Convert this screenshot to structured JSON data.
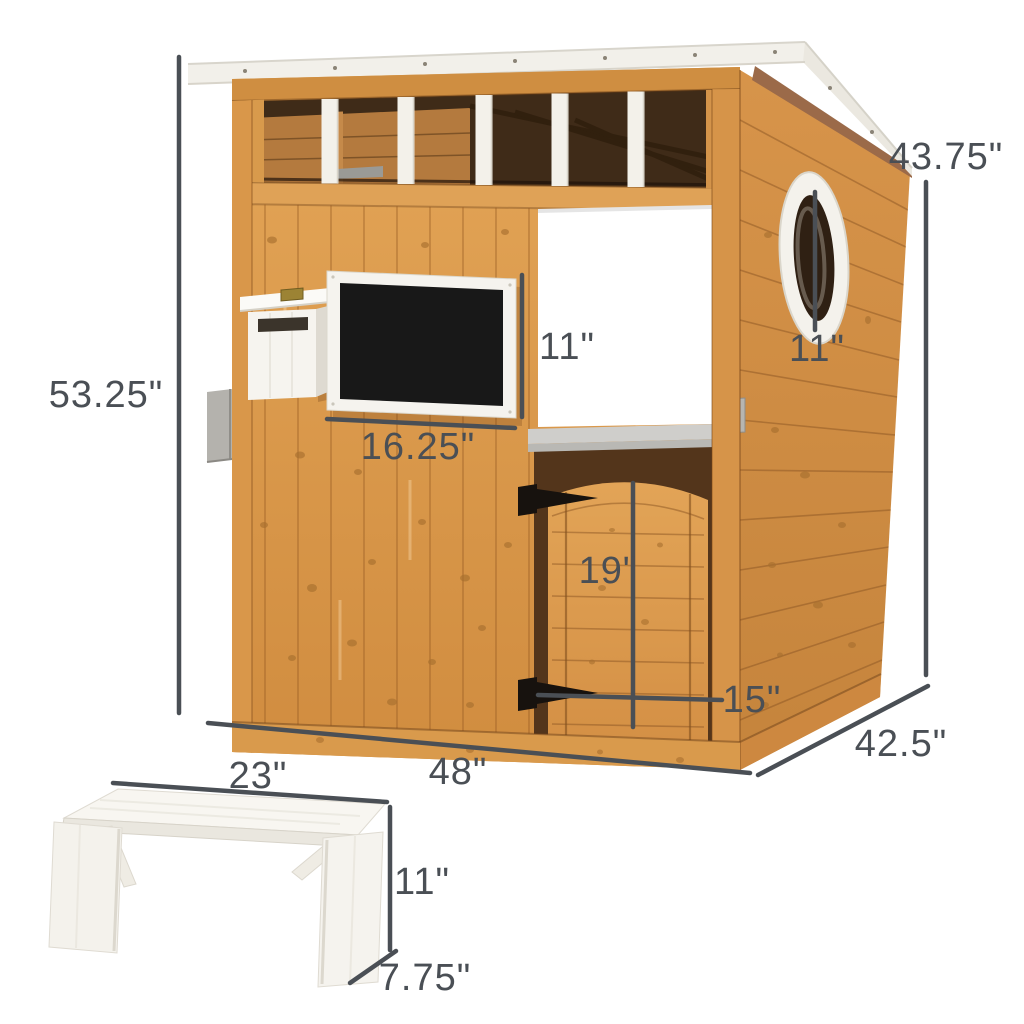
{
  "diagram": {
    "type": "product-dimension-diagram",
    "subject": "wooden kids playhouse with chalkboard, mailbox, porthole window, service window, door and white bench",
    "background_color": "#ffffff",
    "annotation_color": "#4a4f55",
    "wood_color": "#dd9f55",
    "roof_color": "#f2f0ea",
    "labels": {
      "back_height": "43.75\"",
      "front_height": "53.25\"",
      "chalkboard_height": "11\"",
      "chalkboard_width": "16.25\"",
      "porthole_height": "11\"",
      "door_height": "19\"",
      "door_width": "15\"",
      "base_width": "48\"",
      "base_depth": "42.5\"",
      "bench_width": "23\"",
      "bench_height": "11\"",
      "bench_depth": "7.75\""
    }
  }
}
